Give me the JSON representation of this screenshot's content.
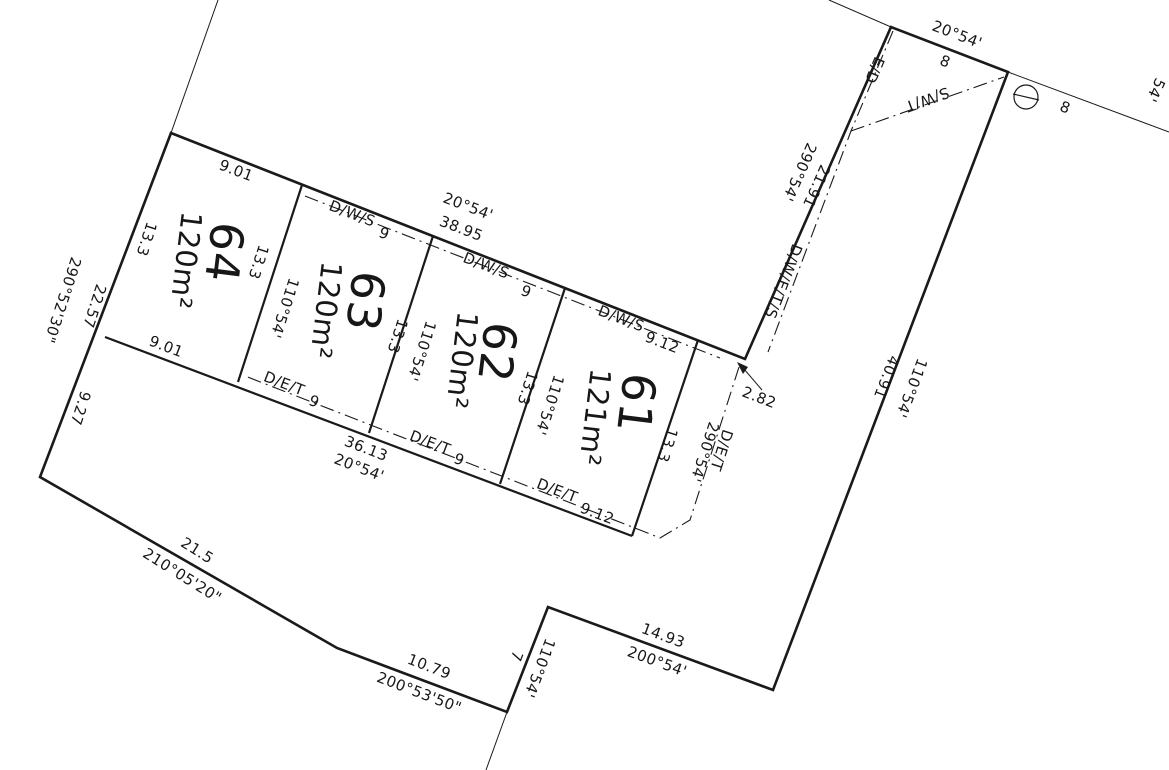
{
  "plan": {
    "lots": [
      {
        "number": "64",
        "area": "120m²"
      },
      {
        "number": "63",
        "area": "120m²"
      },
      {
        "number": "62",
        "area": "120m²"
      },
      {
        "number": "61",
        "area": "121m²"
      }
    ],
    "dims": {
      "d901": "9.01",
      "b2054": "20°54'",
      "road_total": "38.95",
      "w9": "9",
      "w912": "9.12",
      "d133": "13.3",
      "b11054": "110°54'",
      "d2257": "22.57",
      "b2905230": "290°52'30\"",
      "d927": "9.27",
      "rear_total": "36.13",
      "b29054": "290°54'",
      "d282": "2.82",
      "d215": "21.5",
      "b2100520": "210°05'20\"",
      "d1079": "10.79",
      "b2005350": "200°53'50\"",
      "d7": "7",
      "d1493": "14.93",
      "b20054": "200°54'",
      "d4091": "40.91",
      "d2191": "21.91",
      "d8": "8",
      "cut54": "54'"
    },
    "easements": {
      "dws": "D/W/S",
      "det": "D/E/T",
      "dwets": "D/W/E/T/S",
      "ed": "E/D",
      "swt": "S/W/T"
    }
  }
}
